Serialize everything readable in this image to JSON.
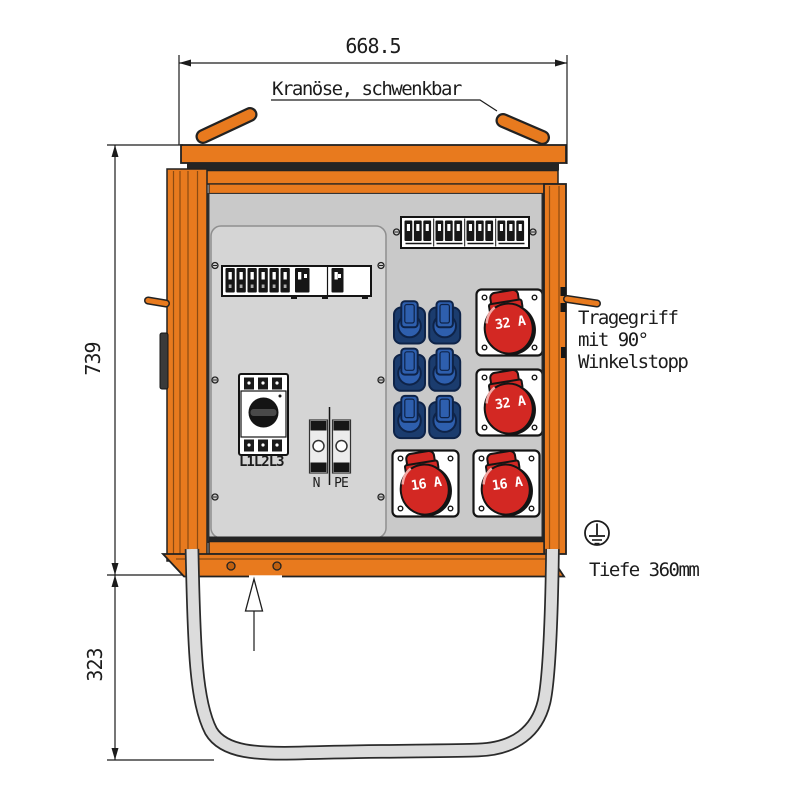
{
  "drawing": {
    "dim_width": "668.5",
    "dim_height_body": "739",
    "dim_height_stand": "323",
    "label_crane": "Kranöse, schwenkbar",
    "label_handle_1": "Tragegriff",
    "label_handle_2": "mit 90°",
    "label_handle_3": "Winkelstopp",
    "label_depth": "Tiefe 360mm",
    "label_main_switch": "L1L2L3",
    "label_neutral": "N",
    "label_earth": "PE"
  },
  "sockets": {
    "cee": [
      "32 A",
      "32 A",
      "16 A",
      "16 A"
    ],
    "blue_socket_rows": 3,
    "blue_socket_cols": 2
  },
  "breakers": {
    "top_strip_groups": 4,
    "top_strip_per_group": 3,
    "left_row_modules": 6,
    "left_row_wide_modules": 2
  },
  "colors": {
    "orange": "#E87A1E",
    "orangedark": "#9C5110",
    "red": "#D32823",
    "blue": "#2E5FAE",
    "bluedark": "#0E2348",
    "panel": "#C9C9C9",
    "plate": "#D5D5D5",
    "tube": "#DCDCDC",
    "ink": "#1C1C1C"
  }
}
